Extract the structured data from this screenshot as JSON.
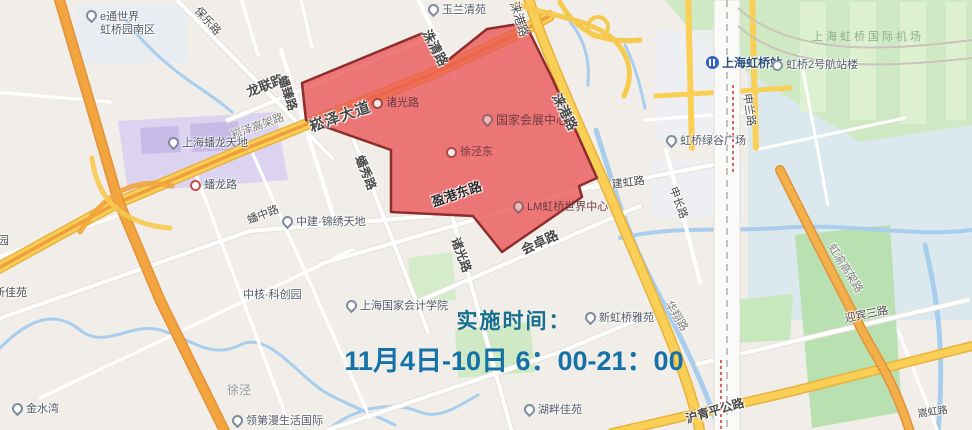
{
  "announcement": {
    "line1": "实施时间：",
    "line2": "11月4日-10日 6：00-21：00",
    "text_color_line1": "#17708f",
    "text_color_line2": "#1572a8"
  },
  "restricted_zone": {
    "fill_color": "#ea5a5a",
    "border_color": "#8e2d2d"
  },
  "map_colors": {
    "background": "#f1eee9",
    "highway_yellow": "#f9cf55",
    "expressway_orange": "#ef9f3b",
    "water_blue": "#a9cdec",
    "park_green": "#cfe9c4",
    "commercial_purple": "#dbd3f0"
  },
  "labels": {
    "etong_line1": "e通世界",
    "etong_line2": "虹桥园南区",
    "baole_rd": "保乐路",
    "yulan_qingyuan": "玉兰清苑",
    "longlian_rd": "龙联路",
    "zhuqing_rd": "洙清路",
    "panzhen_rd": "蟠臻路",
    "songze_viaduct": "崧泽高架路",
    "songze_avenue": "崧泽大道",
    "shanghai_panlong": "上海蟠龙天地",
    "panlong_rd": "蟠龙路",
    "panzhong_rd": "蟠中路",
    "zhongjian_jinxiu": "中建·锦绣天地",
    "panxiu_rd": "蟠秀路",
    "zhuguang_station": "诸光路",
    "necc": "国家会展中心",
    "xujingdong_station": "徐泾东",
    "laigang_rd": "涞港路",
    "laigang_rd_top": "涞港路",
    "yinggang_east_rd": "盈港东路",
    "zhuguang_rd": "诸光路",
    "huizhuo_rd": "会卓路",
    "lm_center": "LM虹桥世界中心",
    "jianhong_rd": "建虹路",
    "hongqiao_station": "上海虹桥站",
    "terminal2": "虹桥2号航站楼",
    "shenlan_rd": "申兰路",
    "green_valley": "虹桥绿谷广场",
    "shenchang_rd": "申长路",
    "airport": "上海虹桥国际机场",
    "hongyu_viaduct": "虹渝高架路",
    "yingbin3_rd": "迎宾三路",
    "songhong_rd": "嵩虹路",
    "huaxiang_rd": "华翔路",
    "huqingping_hwy": "沪青平公路",
    "hupan_jiayuan": "湖畔佳苑",
    "xinhongqiao_yayuan": "新虹桥雅苑",
    "accounting_institute": "上海国家会计学院",
    "zhonghe_park": "中核·科创园",
    "xujing": "徐泾",
    "jinshuiwan": "金水湾",
    "lingdiman": "领第漫生活国际",
    "xinjiayuan": "新佳苑",
    "yuan_partial": "园"
  }
}
